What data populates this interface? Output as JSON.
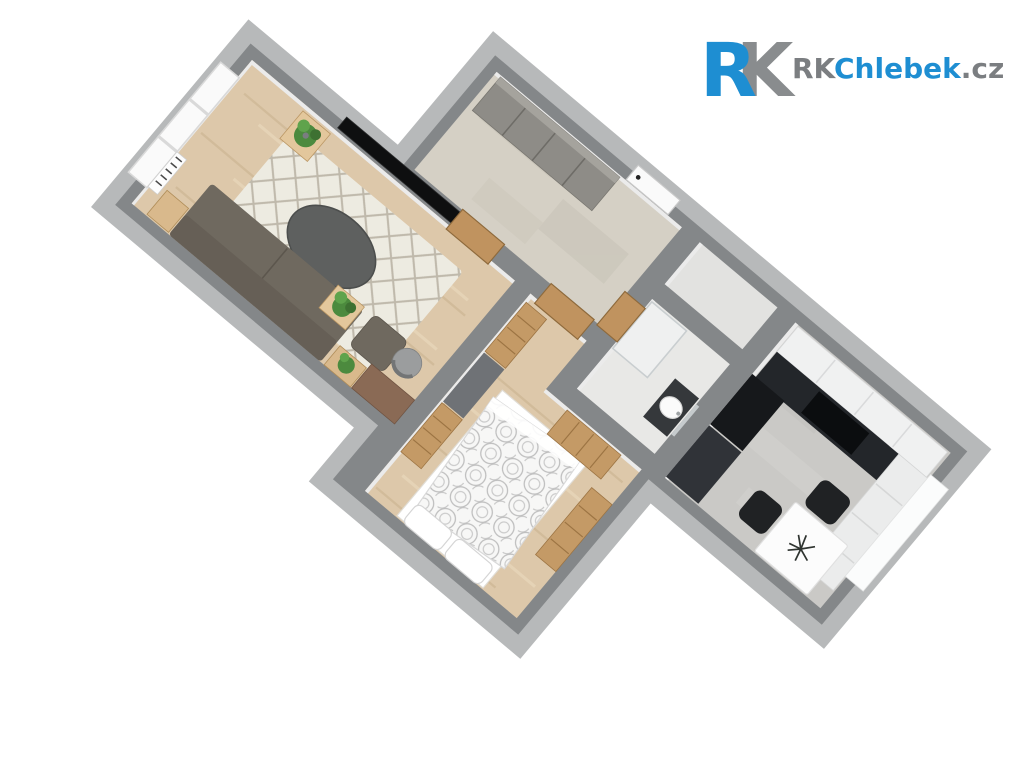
{
  "scene": {
    "description": "3D top-down floor plan rendering of a one-bedroom apartment",
    "view": "rotated bird's-eye axonometric, apartment tilted about 40 degrees",
    "background_color": "#ffffff",
    "wall_color": "#848789",
    "wall_outer_band_color": "#b7b9ba",
    "inner_wall_face_color": "#ebebeb"
  },
  "logo": {
    "monogram_r": "R",
    "monogram_k": "K",
    "wordmark_prefix": "RK",
    "wordmark_name": "Chlebek",
    "wordmark_tld": ".cz",
    "brand_blue": "#1e8ed2",
    "brand_gray": "#898c8e",
    "text_gray": "#7b7e81"
  },
  "palette": {
    "wood_floor": "#ddc8aa",
    "wood_streak_dark": "#c9b28e",
    "wood_streak_light": "#ecdcc0",
    "hall_tile": "#d5d0c5",
    "bathroom_floor": "#e8e8e6",
    "wc_floor": "#e2e2e0",
    "kitchen_floor": "#cac9c6",
    "rug": "#edebe1",
    "rug_lattice": "#b7b0a2",
    "sofa": "#6f695f",
    "coffee_table": "#5e605f",
    "tv": "#0e0f10",
    "oak_furniture": "#c49a66",
    "wardrobe_gray": "#8e8c87",
    "kitchen_black": "#23262a",
    "kitchen_white": "#f0f1f1",
    "dining_chair_black": "#202224",
    "plant_green": "#4c8a3e",
    "desk_brown": "#8a6a55"
  },
  "rooms": [
    {
      "name": "living-room",
      "floor": "light oak planks",
      "furniture": [
        "sofa",
        "ottoman pouf",
        "oval coffee table",
        "cream diamond-lattice rug",
        "wall-mounted TV",
        "triple window",
        "radiator",
        "desk",
        "desk chair",
        "wooden side tables",
        "potted plants"
      ]
    },
    {
      "name": "hallway",
      "floor": "beige tile",
      "furniture": [
        "built-in wardrobe",
        "white entrance door",
        "oak interior doors"
      ]
    },
    {
      "name": "bathroom",
      "floor": "white tile",
      "furniture": [
        "washbasin vanity",
        "mirror",
        "shower enclosure",
        "oak door"
      ]
    },
    {
      "name": "wc-niche",
      "floor": "light tile",
      "furniture": []
    },
    {
      "name": "kitchen",
      "floor": "grey tile",
      "furniture": [
        "black kitchen counter",
        "cooktop",
        "black tall units",
        "white upper cabinets",
        "white base cabinets",
        "window",
        "white dining table",
        "two black chairs",
        "dark table plant"
      ]
    },
    {
      "name": "bedroom",
      "floor": "light oak planks",
      "furniture": [
        "double bed with grey fan-pattern duvet",
        "two white pillows",
        "oak drawer chests",
        "grey wardrobe fronts",
        "oak dresser"
      ]
    }
  ]
}
